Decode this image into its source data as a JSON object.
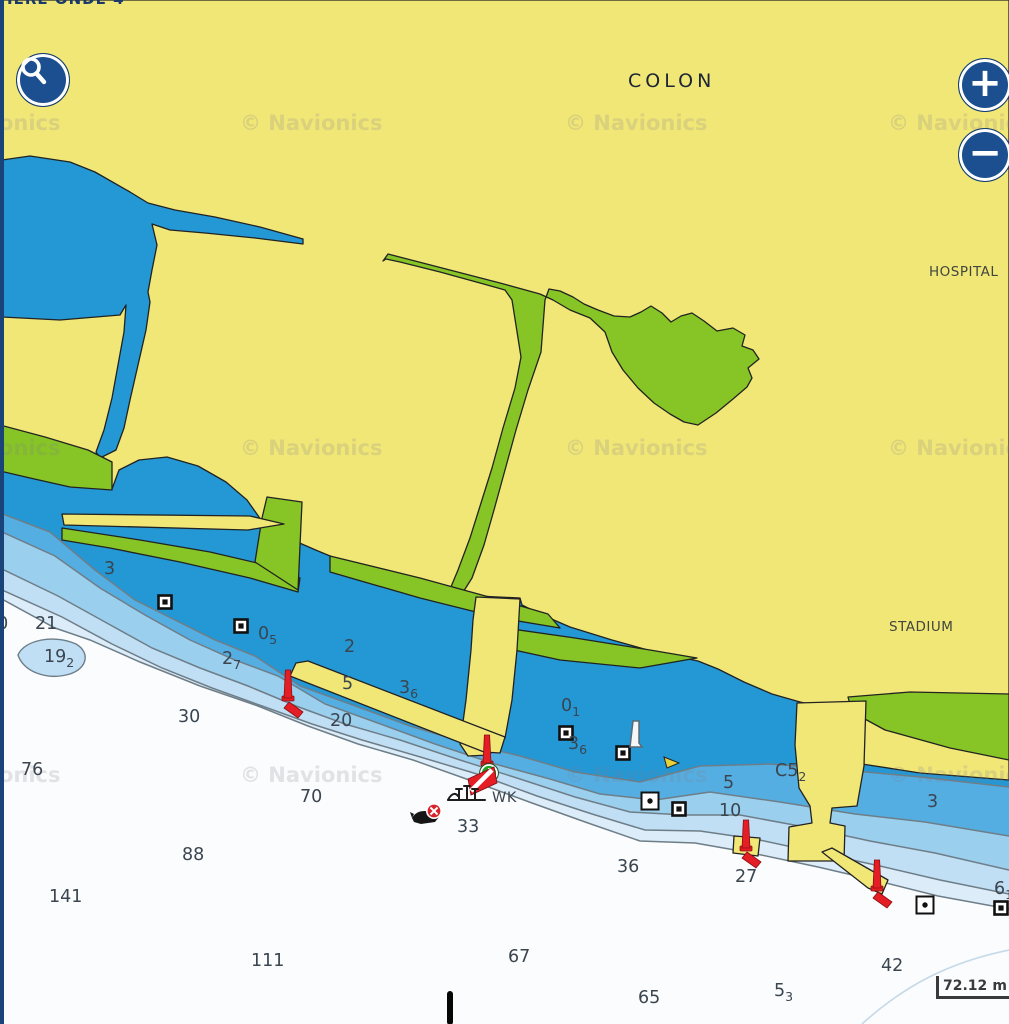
{
  "ui": {
    "top_partial_label": "IERE ONDE 4",
    "search_button": {
      "icon": "magnifier"
    },
    "zoom_in_label": "+",
    "zoom_out_label": "−",
    "scale": {
      "value": "72.12",
      "unit": "m"
    }
  },
  "labels": {
    "city": "COLON",
    "hospital": "HOSPITAL",
    "stadium": "STADIUM"
  },
  "watermark": {
    "text": "© Navionics",
    "xs": [
      -82,
      240,
      565,
      888
    ],
    "ys": [
      130,
      455,
      782
    ]
  },
  "colors": {
    "navy_accent": "#1b4f8f",
    "land_yellow": "#f1e777",
    "vegetation_green": "#86c525",
    "water_dark": "#2398d5",
    "water_medium": "#55aee2",
    "water_light": "#9bcfee",
    "water_lighter": "#c0def4",
    "water_palest": "#dcecf8",
    "deep_white": "#fbfcfd",
    "contour_gray": "#6e7e88",
    "beacon_red": "#e51d25",
    "marker_green": "#21a127",
    "sounding_text": "#3a4550"
  },
  "chart": {
    "soundings": [
      {
        "t": "3",
        "x": 104,
        "y": 574
      },
      {
        "t": "20",
        "x": -14,
        "y": 629
      },
      {
        "t": "21",
        "x": 35,
        "y": 629
      },
      {
        "t": "19",
        "s": "2",
        "x": 44,
        "y": 662
      },
      {
        "t": "0",
        "s": "5",
        "x": 258,
        "y": 639
      },
      {
        "t": "2",
        "s": "7",
        "x": 222,
        "y": 664
      },
      {
        "t": "2",
        "x": 344,
        "y": 652
      },
      {
        "t": "5",
        "x": 342,
        "y": 689
      },
      {
        "t": "3",
        "s": "6",
        "x": 399,
        "y": 693
      },
      {
        "t": "20",
        "x": 330,
        "y": 726
      },
      {
        "t": "30",
        "x": 178,
        "y": 722
      },
      {
        "t": "76",
        "x": 21,
        "y": 775
      },
      {
        "t": "70",
        "x": 300,
        "y": 802
      },
      {
        "t": "88",
        "x": 182,
        "y": 860
      },
      {
        "t": "141",
        "x": 49,
        "y": 902
      },
      {
        "t": "111",
        "x": 251,
        "y": 966
      },
      {
        "t": "33",
        "x": 457,
        "y": 832
      },
      {
        "t": "0",
        "s": "1",
        "x": 561,
        "y": 711
      },
      {
        "t": "3",
        "s": "6",
        "x": 568,
        "y": 749
      },
      {
        "t": "5",
        "x": 723,
        "y": 788
      },
      {
        "t": "C5",
        "s": "2",
        "x": 775,
        "y": 776
      },
      {
        "t": "10",
        "x": 719,
        "y": 816
      },
      {
        "t": "36",
        "x": 617,
        "y": 872
      },
      {
        "t": "27",
        "x": 735,
        "y": 882
      },
      {
        "t": "3",
        "x": 927,
        "y": 807
      },
      {
        "t": "67",
        "x": 508,
        "y": 962
      },
      {
        "t": "65",
        "x": 638,
        "y": 1003
      },
      {
        "t": "5",
        "s": "3",
        "x": 774,
        "y": 996
      },
      {
        "t": "42",
        "x": 881,
        "y": 971
      },
      {
        "t": "6",
        "s": "1",
        "x": 994,
        "y": 894
      }
    ],
    "texts": [
      {
        "t": "WK",
        "x": 492,
        "y": 802
      }
    ],
    "symbols": {
      "beacons_red": [
        {
          "x": 288,
          "y": 700,
          "flag": "right"
        },
        {
          "x": 487,
          "y": 765,
          "flag": "none"
        },
        {
          "x": 746,
          "y": 850,
          "flag": "right"
        },
        {
          "x": 877,
          "y": 890,
          "flag": "right"
        }
      ],
      "squares": [
        {
          "x": 165,
          "y": 602
        },
        {
          "x": 241,
          "y": 626
        },
        {
          "x": 566,
          "y": 733
        },
        {
          "x": 623,
          "y": 753
        },
        {
          "x": 679,
          "y": 809
        },
        {
          "x": 1001,
          "y": 908
        }
      ],
      "dot_squares": [
        {
          "x": 650,
          "y": 801
        },
        {
          "x": 925,
          "y": 905
        }
      ],
      "white_pile": [
        {
          "x": 636,
          "y": 735
        }
      ],
      "yellow_cone": [
        {
          "x": 671,
          "y": 762
        }
      ],
      "green_marker": [
        {
          "x": 489,
          "y": 773
        }
      ],
      "dive_flag": [
        {
          "x": 482,
          "y": 781
        }
      ],
      "wreck_mast": [
        {
          "x": 467,
          "y": 796
        }
      ],
      "wreck_poi": [
        {
          "x": 427,
          "y": 816
        }
      ],
      "black_bar": [
        {
          "x": 450,
          "y": 991
        }
      ]
    }
  }
}
